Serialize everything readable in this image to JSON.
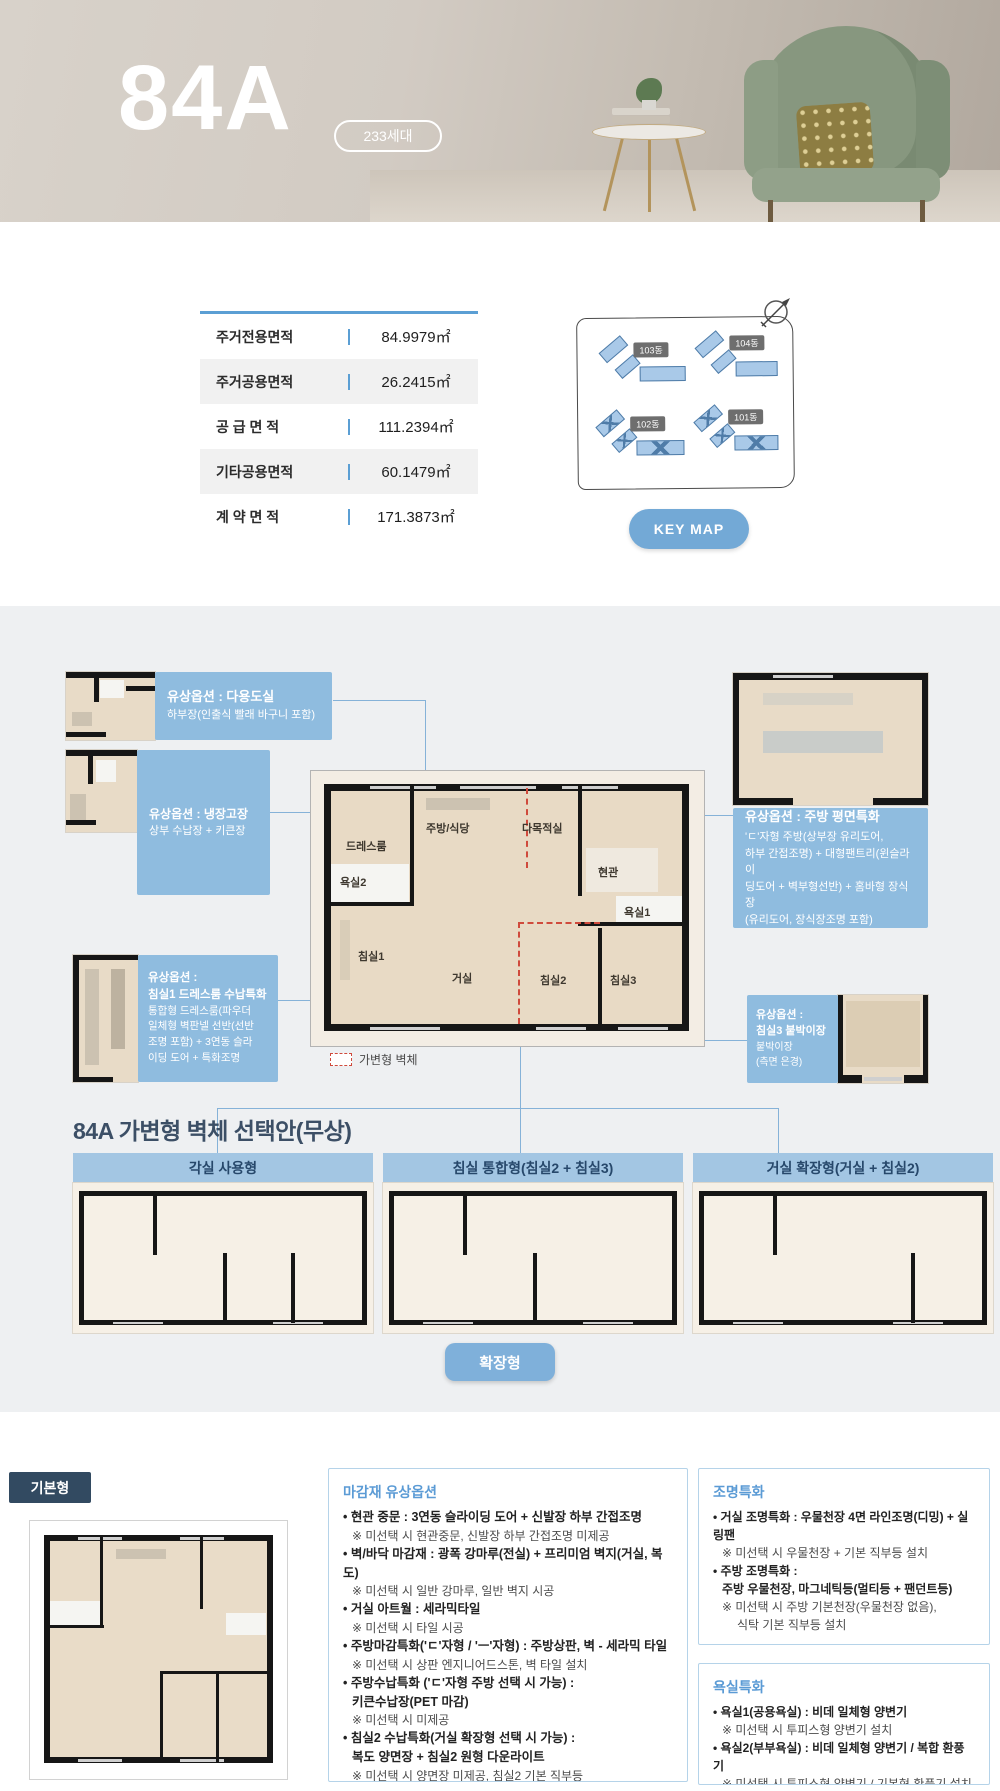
{
  "hero": {
    "title": "84A",
    "badge": "233세대"
  },
  "area_table": {
    "rows": [
      {
        "label": "주거전용면적",
        "value": "84.9979㎡"
      },
      {
        "label": "주거공용면적",
        "value": "26.2415㎡"
      },
      {
        "label": "공 급 면 적",
        "value": "111.2394㎡"
      },
      {
        "label": "기타공용면적",
        "value": "60.1479㎡"
      },
      {
        "label": "계 약 면 적",
        "value": "171.3873㎡"
      }
    ]
  },
  "keymap": {
    "button": "KEY MAP",
    "buildings": [
      {
        "label": "103동"
      },
      {
        "label": "104동"
      },
      {
        "label": "102동"
      },
      {
        "label": "101동"
      }
    ]
  },
  "plan": {
    "rooms": {
      "dressroom": "드레스룸",
      "bath2": "욕실2",
      "bed1": "침실1",
      "kitchen": "주방/식당",
      "multi": "다목적실",
      "entry": "현관",
      "bath1": "욕실1",
      "living": "거실",
      "bed2": "침실2",
      "bed3": "침실3"
    },
    "legend": "가변형 벽체"
  },
  "callouts": [
    {
      "title1": "유상옵션 : 다용도실",
      "title2": "",
      "l0": "하부장(인출식 빨래 바구니 포함)",
      "l1": "",
      "l2": "",
      "l3": ""
    },
    {
      "title1": "유상옵션 : 냉장고장",
      "title2": "",
      "l0": "상부 수납장 + 키큰장",
      "l1": "",
      "l2": "",
      "l3": ""
    },
    {
      "title1": "유상옵션 :",
      "title2": "침실1 드레스룸 수납특화",
      "l0": "통합형 드레스룸(파우더",
      "l1": "일체형 벽판넬 선반(선반",
      "l2": "조명 포함) + 3연동 슬라",
      "l3": "이딩 도어 + 특화조명"
    },
    {
      "title1": "유상옵션 : 주방 평면특화",
      "title2": "",
      "l0": "'ㄷ'자형 주방(상부장 유리도어,",
      "l1": "하부 간접조명) + 대형팬트리(윈슬라이",
      "l2": "딩도어 + 벽부형선반) + 홈바형 장식장",
      "l3": "(유리도어, 장식장조명 포함)"
    },
    {
      "title1": "유상옵션 :",
      "title2": "침실3 붙박이장",
      "l0": "붙박이장",
      "l1": "(측면 은경)",
      "l2": "",
      "l3": ""
    }
  ],
  "variant_section": {
    "title": "84A 가변형 벽체 선택안(무상)",
    "options": [
      {
        "label": "각실 사용형"
      },
      {
        "label": "침실 통합형(침실2 + 침실3)"
      },
      {
        "label": "거실 확장형(거실 + 침실2)"
      }
    ],
    "expand_button": "확장형"
  },
  "basic": {
    "label": "기본형"
  },
  "option_boxes": [
    {
      "title": "마감재 유상옵션",
      "items": [
        {
          "main": "현관 중문 : 3연동 슬라이딩 도어 + 신발장 하부 간접조명",
          "main2": "",
          "sub": "※ 미선택 시 현관중문, 신발장 하부 간접조명 미제공",
          "sub2": ""
        },
        {
          "main": "벽/바닥 마감재 : 광폭 강마루(전실) + 프리미엄 벽지(거실, 복도)",
          "main2": "",
          "sub": "※ 미선택 시 일반 강마루, 일반 벽지 시공",
          "sub2": ""
        },
        {
          "main": "거실 아트월 : 세라믹타일",
          "main2": "",
          "sub": "※ 미선택 시 타일 시공",
          "sub2": ""
        },
        {
          "main": "주방마감특화('ㄷ'자형 / 'ㅡ'자형) : 주방상판, 벽 - 세라믹 타일",
          "main2": "",
          "sub": "※ 미선택 시 상판 엔지니어드스톤, 벽 타일 설치",
          "sub2": ""
        },
        {
          "main": "주방수납특화 ('ㄷ'자형 주방 선택 시 가능) :",
          "main2": "키큰수납장(PET 마감)",
          "sub": "※ 미선택 시 미제공",
          "sub2": ""
        },
        {
          "main": "침실2 수납특화(거실 확장형 선택 시 가능) :",
          "main2": "복도 양면장 + 침실2 원형 다운라이트",
          "sub": "※ 미선택 시 양면장 미제공, 침실2 기본 직부등",
          "sub2": ""
        }
      ]
    },
    {
      "title": "조명특화",
      "items": [
        {
          "main": "거실 조명특화 : 우물천장 4면 라인조명(디밍) + 실링팬",
          "main2": "",
          "sub": "※ 미선택 시 우물천장 + 기본 직부등 설치",
          "sub2": ""
        },
        {
          "main": "주방 조명특화 :",
          "main2": "주방 우물천장, 마그네틱등(멀티등 + 팬던트등)",
          "sub": "※ 미선택 시 주방 기본천장(우물천장 없음),",
          "sub2": "식탁 기본 직부등 설치"
        }
      ]
    },
    {
      "title": "욕실특화",
      "items": [
        {
          "main": "욕실1(공용욕실) : 비데 일체형 양변기",
          "main2": "",
          "sub": "※ 미선택 시 투피스형 양변기 설치",
          "sub2": ""
        },
        {
          "main": "욕실2(부부욕실) : 비데 일체형 양변기 / 복합 환풍기",
          "main2": "",
          "sub": "※ 미선택 시 투피스형 양변기 / 기본형 환풍기 설치",
          "sub2": ""
        }
      ]
    }
  ],
  "colors": {
    "accent_blue": "#5b9fd4",
    "callout_blue": "#8fbcdf",
    "header_bar_blue": "#a3c6e3",
    "button_blue": "#73a9d6",
    "navy": "#324a61",
    "red_dashed_wall": "#cf4a3c",
    "section_bg": "#eef0f2",
    "hero_beige": "#c8c0b6"
  }
}
